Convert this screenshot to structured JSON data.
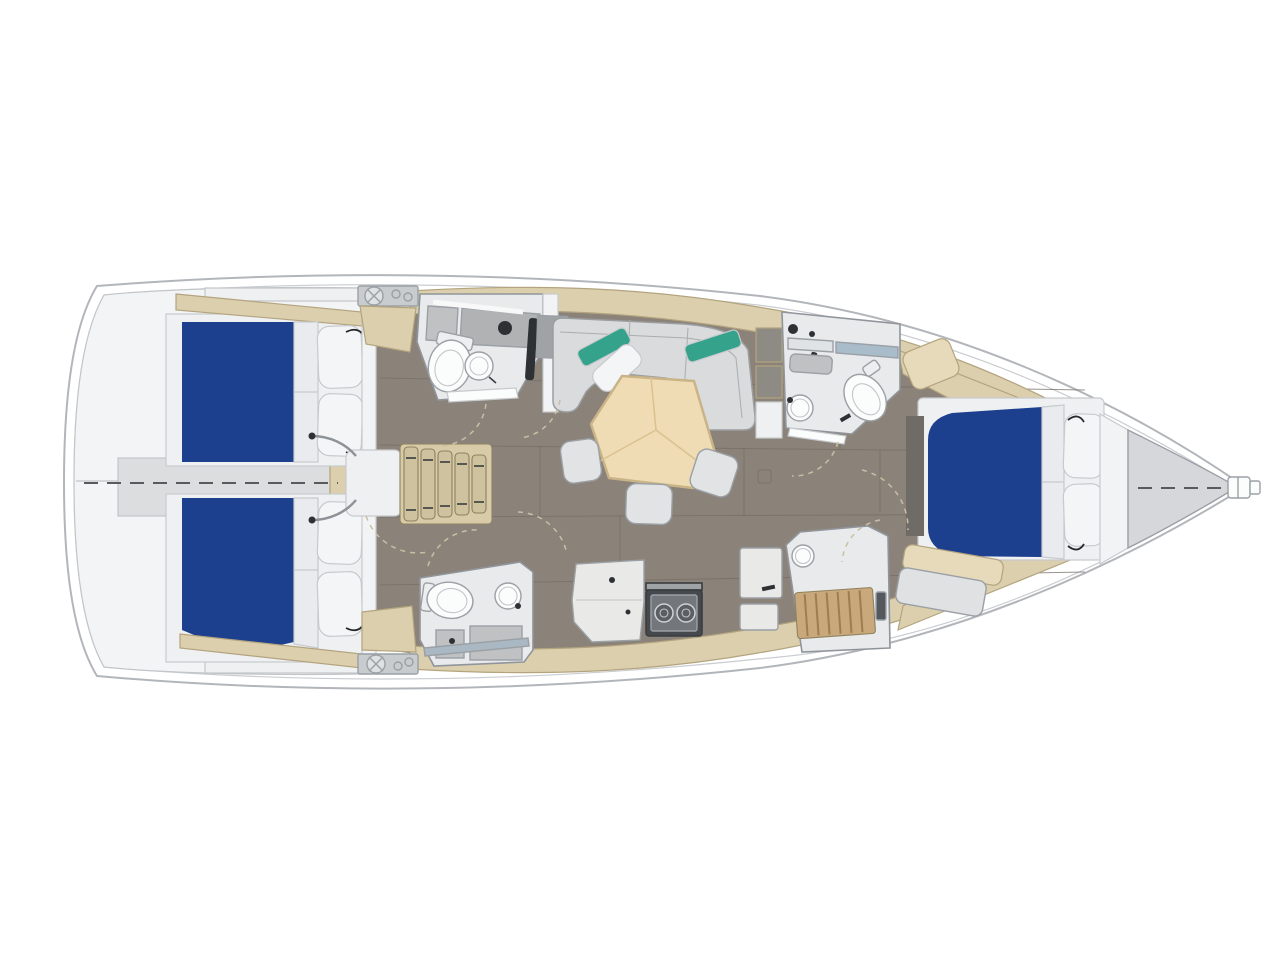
{
  "diagram": {
    "type": "yacht-interior-floor-plan",
    "view": "top-down deck/interior layout, 3D render style",
    "orientation": {
      "bow": "right",
      "stern": "left"
    },
    "areas": [
      {
        "id": "stern-platform",
        "label": "Stern swim platform / transom"
      },
      {
        "id": "aft-cabin-port",
        "label": "Aft cabin (top) with blue double berth and two pillows"
      },
      {
        "id": "aft-cabin-starboard",
        "label": "Aft cabin (bottom) with blue double berth and two pillows"
      },
      {
        "id": "engine-compartment",
        "label": "Engine compartment between aft berths with dashed centerline"
      },
      {
        "id": "companionway",
        "label": "Companionway steps with landing"
      },
      {
        "id": "aft-head-port",
        "label": "Aft head (top): toilet, round sink, counter, shower column"
      },
      {
        "id": "aft-head-starboard",
        "label": "Aft head (bottom): toilet, round sink, vanity, shower rail"
      },
      {
        "id": "saloon",
        "label": "Saloon: L-shaped sofa with teal and white pillows"
      },
      {
        "id": "saloon-table",
        "label": "Pentagonal wooden saloon table with three stools"
      },
      {
        "id": "galley",
        "label": "Galley: counters and two-burner stove"
      },
      {
        "id": "forward-head",
        "label": "Forward head: mirror, sink, toilet"
      },
      {
        "id": "forward-shower",
        "label": "Forward shower with teak grate floor"
      },
      {
        "id": "forward-cabin",
        "label": "Forward owner's cabin with blue double berth, two pillows, seat and bench"
      },
      {
        "id": "anchor-locker",
        "label": "Bow anchor locker / forepeak with dashed centerline and bow fitting"
      },
      {
        "id": "deck-winches",
        "label": "Deck winch plates port and starboard at companionway"
      }
    ],
    "berth_count": 3,
    "head_count": 3
  },
  "colors": {
    "page_bg": "#ffffff",
    "hull_fill": "#ffffff",
    "transom": "#f3f4f5",
    "step_white": "#eff0f1",
    "deck_tan": "#dbcfae",
    "seat_beige": "#e7dabb",
    "stair_wood": "#cfc29e",
    "stair_base": "#d8cba8",
    "bed_blue": "#1c3f8e",
    "mattress": "#e9ebee",
    "platform": "#eef0f2",
    "pillow": "#f4f5f7",
    "floor": "#8b8379",
    "mat": "#6f6b66",
    "bulkhead": "#f2f3f4",
    "room": "#e9eaeb",
    "fixture": "#fbfcfc",
    "tank": "#eceeef",
    "sofa": "#d9dbdc",
    "teal": "#35a28c",
    "table": "#f0dcb4",
    "stool": "#e2e3e4",
    "engine_box": "#dcddde",
    "counter_gray": "#bfc1c3",
    "counter_gray2": "#b0b2b4",
    "galley_counter": "#e9e9e8",
    "stove_body": "#45484c",
    "stove_panel": "#73777c",
    "burner": "#5b5f64",
    "grate": "#c9a87b",
    "mirror_light": "#dfe3e6",
    "mirror_blue": "#a9bcca",
    "shower_rail": "#a9b8c2",
    "dark": "#2e3134",
    "panel_gray": "#9fa3a6",
    "locker_dark": "#8e8a84",
    "forepeak": "#d5d7da",
    "winch_plate": "#c9cccf",
    "winch": "#dfe2e4",
    "bench": "#dfe1e2",
    "vent": "#55585c"
  }
}
